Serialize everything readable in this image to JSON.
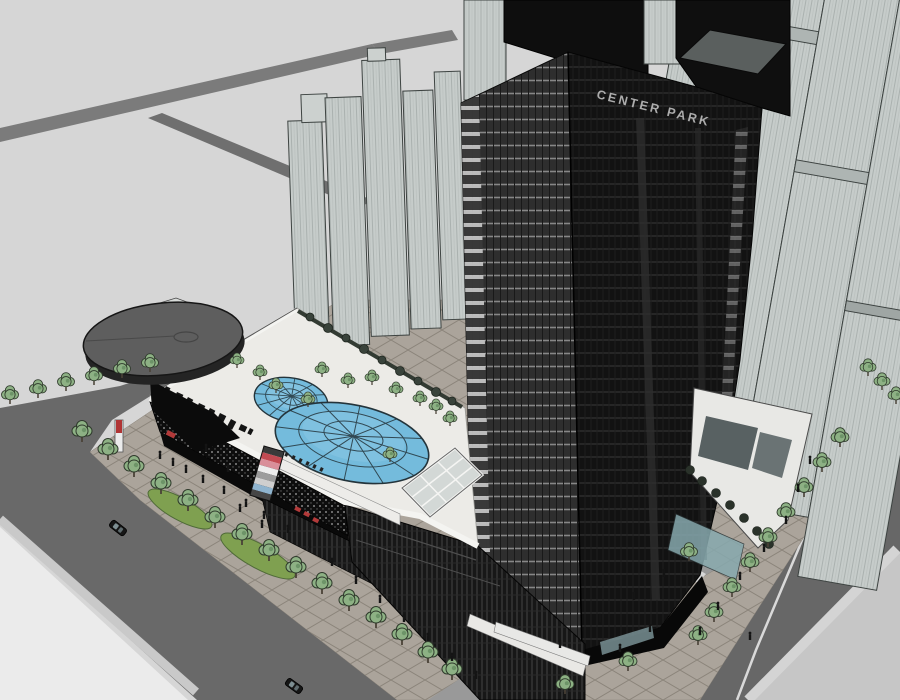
{
  "scene": {
    "type": "3d-architectural-massing-render",
    "description": "Aerial SketchUp-style rendering of a mixed-use development: a dark curtain-wall office tower labeled CENTER PARK rising from a white shopping-mall podium with two blue geodesic skylight domes, a circular disc canopy at the corner, rooftop garden trees, a paved pedestrian plaza with trees and people, perimeter roads with cars, and light-gray background residential towers.",
    "tower": {
      "sign_text": "CENTER PARK"
    },
    "colors": {
      "ground": "#d6d6d6",
      "ground_light": "#ebebeb",
      "road": "#696969",
      "road_secondary": "#7b7b7b",
      "driveway": "#999999",
      "sidewalk_median": "#c9c9c9",
      "plaza_paving": "#aba49b",
      "paving_grid": "#8b847a",
      "lane_marking": "#d9d9d9",
      "mall_roof": "#ecebe7",
      "parapet": "#f4f4f1",
      "mall_facade": "#0d0d0d",
      "dome_glass": "#74bbdc",
      "dome_highlight": "#8fc9e4",
      "dome_frame": "#24343b",
      "skylight": "#d3d8d6",
      "tree_canopy": "#8db184",
      "tree_outline": "#2f3a2c",
      "grass": "#7fa050",
      "tower_glass_dark": "#121212",
      "tower_face": "#2e2e2e",
      "light_building": "#c6ccca",
      "disc_canopy": "#5e5e5e",
      "accent_red": "#b23a3a",
      "wing_white": "#e8e8e5",
      "glass_teal": "#87a9ae"
    },
    "mall_sign_stripes": [
      "#3a3a3a",
      "#c24a52",
      "#d98f9a",
      "#ededed",
      "#9c9c9c",
      "#cfcfcf",
      "#8fb4cf",
      "#464646"
    ]
  }
}
